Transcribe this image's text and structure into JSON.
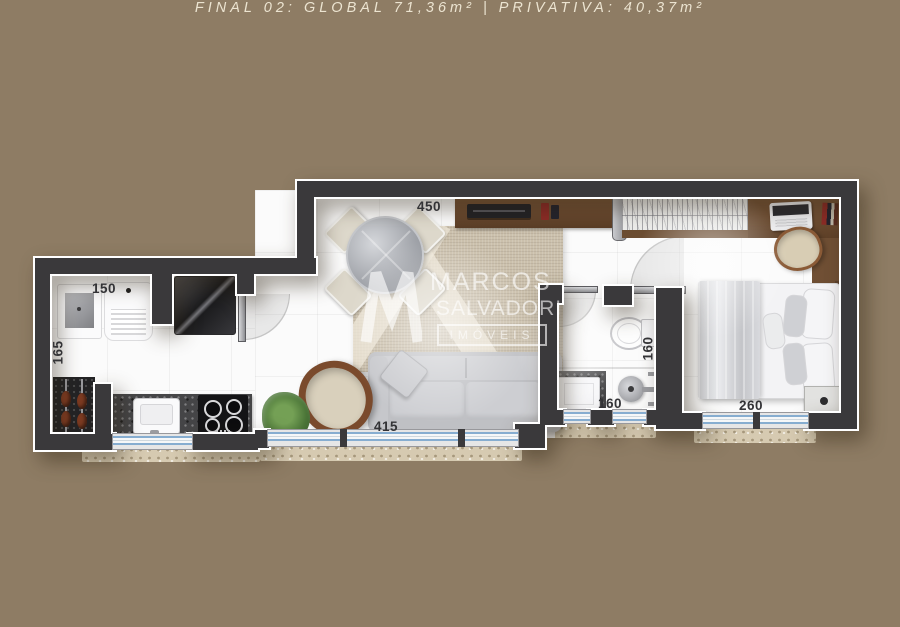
{
  "caption": {
    "text": "FINAL 02: GLOBAL 71,36m² | PRIVATIVA: 40,37m²"
  },
  "dimensions": {
    "living_top_width": "450",
    "service_width": "150",
    "service_depth": "165",
    "living_bottom_width": "415",
    "bath_depth": "160",
    "bath_width": "160",
    "bedroom_width": "260"
  },
  "watermark": {
    "brand_top": "MARCOS",
    "brand_bottom": "SALVADORI",
    "tagline": "IMÓVEIS"
  },
  "colors": {
    "background": "#8e7c64",
    "wall": "#3a393b",
    "wall_trim": "#ffffff",
    "floor": "#fbfbfb",
    "wood": "#6f4f34",
    "rug": "#cbc0ac",
    "window_glass": "#86add0",
    "caption_text": "#ece4d1",
    "dimension_text": "#333336"
  }
}
